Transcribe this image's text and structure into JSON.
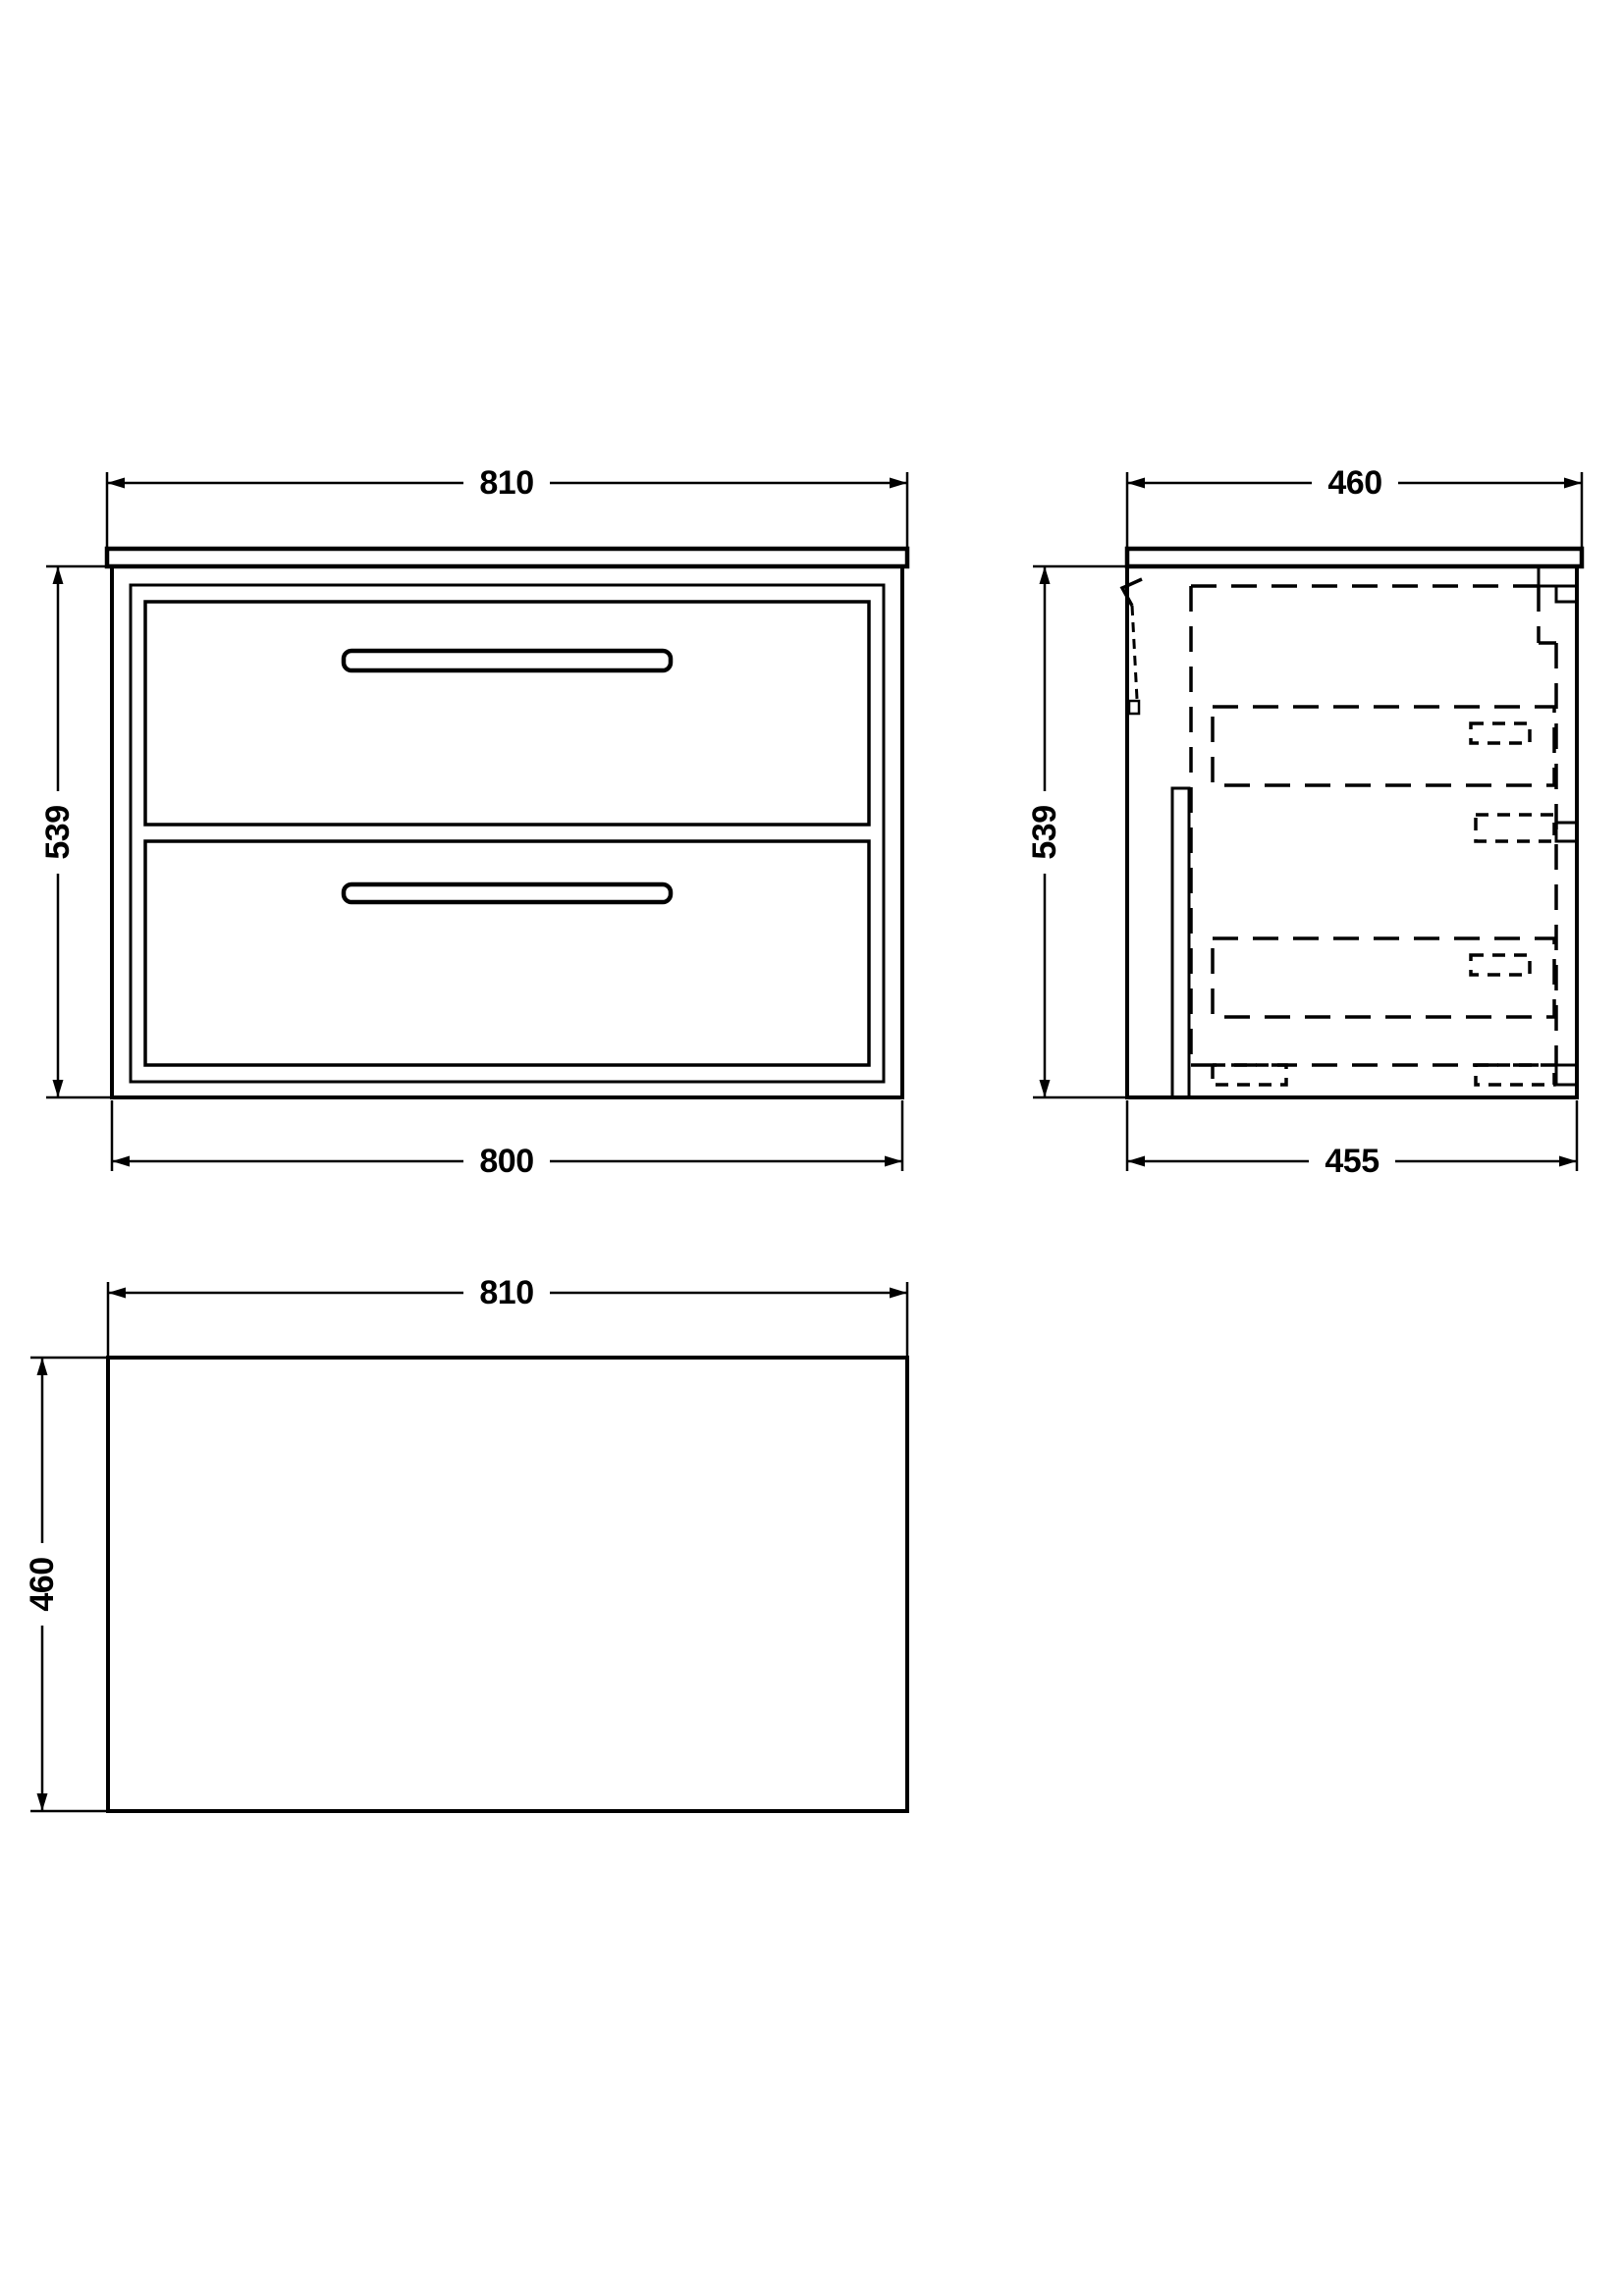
{
  "colors": {
    "ink": "#000000",
    "paper": "#ffffff"
  },
  "views": {
    "front": {
      "dims": {
        "width_top": "810",
        "height": "539",
        "width_bottom": "800"
      }
    },
    "side": {
      "dims": {
        "width_top": "460",
        "height": "539",
        "depth_bottom": "455"
      }
    },
    "plan": {
      "dims": {
        "width_top": "810",
        "depth_left": "460"
      }
    }
  }
}
